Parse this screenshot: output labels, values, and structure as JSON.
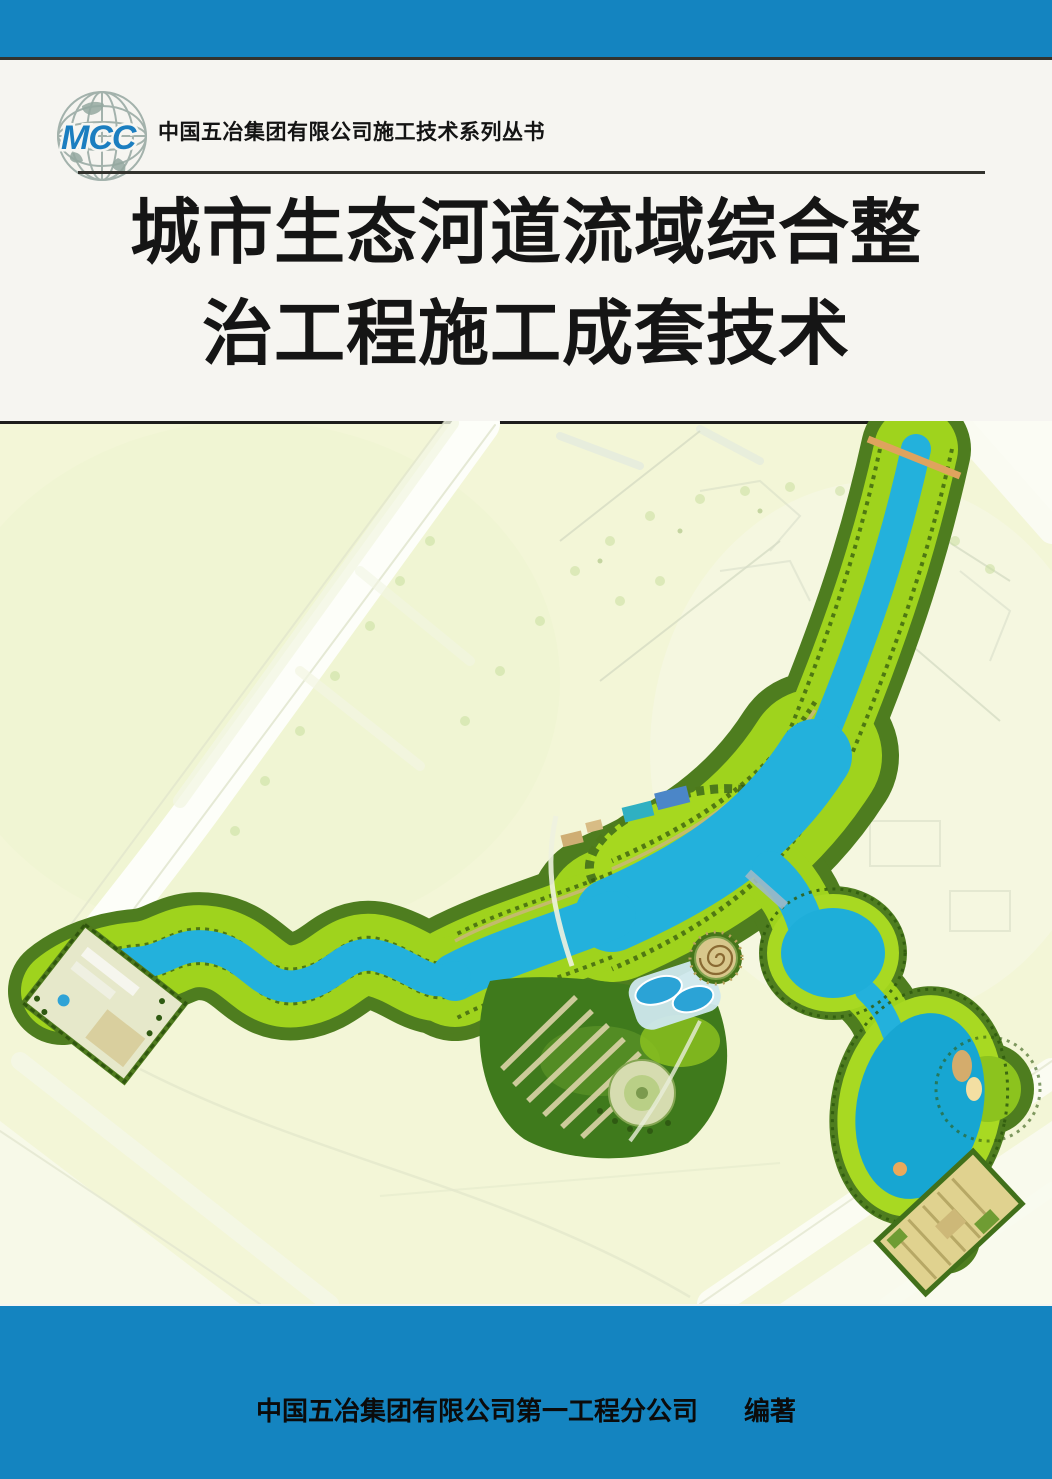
{
  "header": {
    "logo_text": "MCC",
    "series_title": "中国五冶集团有限公司施工技术系列丛书"
  },
  "title": {
    "line1": "城市生态河道流域综合整",
    "line2": "治工程施工成套技术"
  },
  "footer": {
    "publisher": "中国五冶集团有限公司第一工程分公司",
    "role": "编著"
  },
  "colors": {
    "band_blue": "#1484c0",
    "logo_blue": "#1b7ec0",
    "globe_gray": "#a3b2ac",
    "title_black": "#151515",
    "map_background": "#f3f6d7",
    "corridor_green_bright": "#9fd31d",
    "corridor_green_dark": "#4e7d1f",
    "water_blue": "#23b1dc",
    "road_white": "#fdfef9",
    "spiral_tan": "#d8c78c"
  }
}
